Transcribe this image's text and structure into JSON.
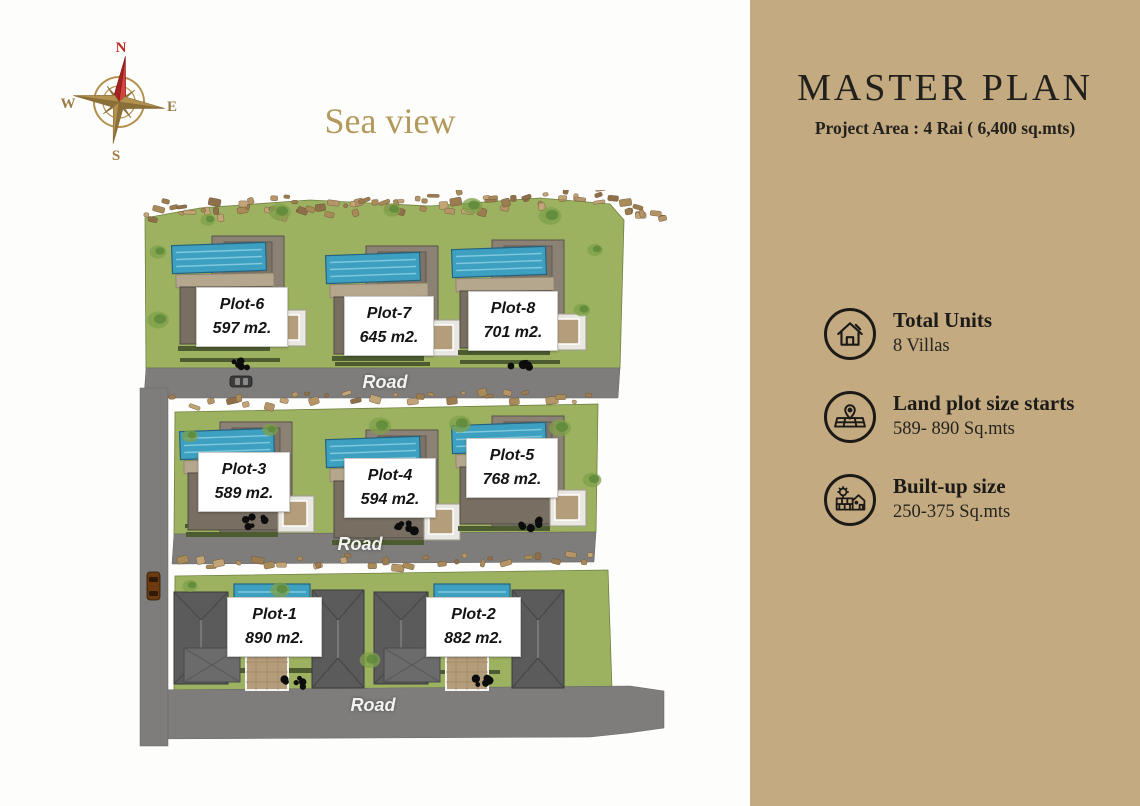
{
  "plan": {
    "sea_view_label": "Sea view",
    "road_label": "Road",
    "compass": {
      "north": "N",
      "east": "E",
      "south": "S",
      "west": "W"
    },
    "plots": [
      {
        "name": "Plot-1",
        "area": "890 m2."
      },
      {
        "name": "Plot-2",
        "area": "882 m2."
      },
      {
        "name": "Plot-3",
        "area": "589 m2."
      },
      {
        "name": "Plot-4",
        "area": "594 m2."
      },
      {
        "name": "Plot-5",
        "area": "768 m2."
      },
      {
        "name": "Plot-6",
        "area": "597 m2."
      },
      {
        "name": "Plot-7",
        "area": "645 m2."
      },
      {
        "name": "Plot-8",
        "area": "701 m2."
      }
    ]
  },
  "sidebar": {
    "title": "MASTER PLAN",
    "subtitle": "Project Area : 4 Rai ( 6,400 sq.mts)",
    "items": [
      {
        "icon": "house-icon",
        "title": "Total Units",
        "value": "8 Villas"
      },
      {
        "icon": "land-plot-icon",
        "title": "Land plot size starts",
        "value": "589- 890 Sq.mts"
      },
      {
        "icon": "built-up-icon",
        "title": "Built-up size",
        "value": "250-375 Sq.mts"
      }
    ],
    "logo": {
      "name_black": "Doctor-",
      "name_red": "Property",
      "domain": ".co.th"
    },
    "colors": {
      "background": "#c3aa80",
      "accent_red": "#e8251d",
      "text": "#1d1b18",
      "gold": "#b2995c"
    }
  }
}
